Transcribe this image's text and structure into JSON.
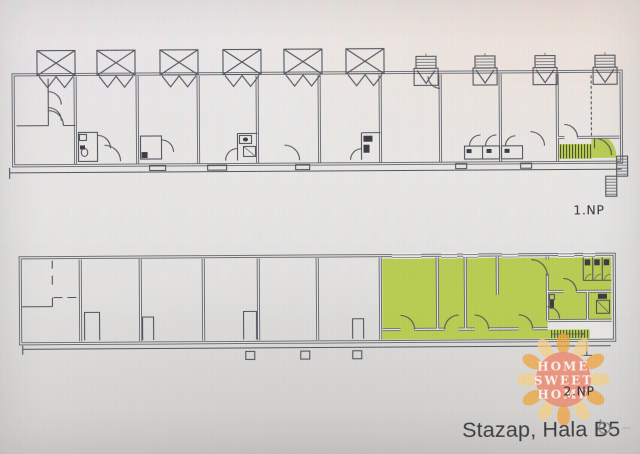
{
  "colors": {
    "background": "#e7e6e4",
    "wall_line": "#50535b",
    "highlight": "#b8cc52",
    "stair_tread": "#3a3e22",
    "plan_label": "#2f3238",
    "caption_text": "#3d3d3f",
    "icon_gray": "#85858a",
    "logo_circle": "#ec8a72",
    "logo_ray_orange": "#f1a43c",
    "logo_ray_yellow": "#f6cf86",
    "logo_text": "#fdf4ec"
  },
  "floorplans": {
    "upper": {
      "label": "1.NP"
    },
    "lower": {
      "label": "2.NP"
    }
  },
  "caption": {
    "title": "Stazap, Hala B5"
  },
  "watermark": {
    "line1": "HOME",
    "line2": "SWEET",
    "line3": "HOME"
  },
  "icons": {
    "rotate": "↻"
  }
}
